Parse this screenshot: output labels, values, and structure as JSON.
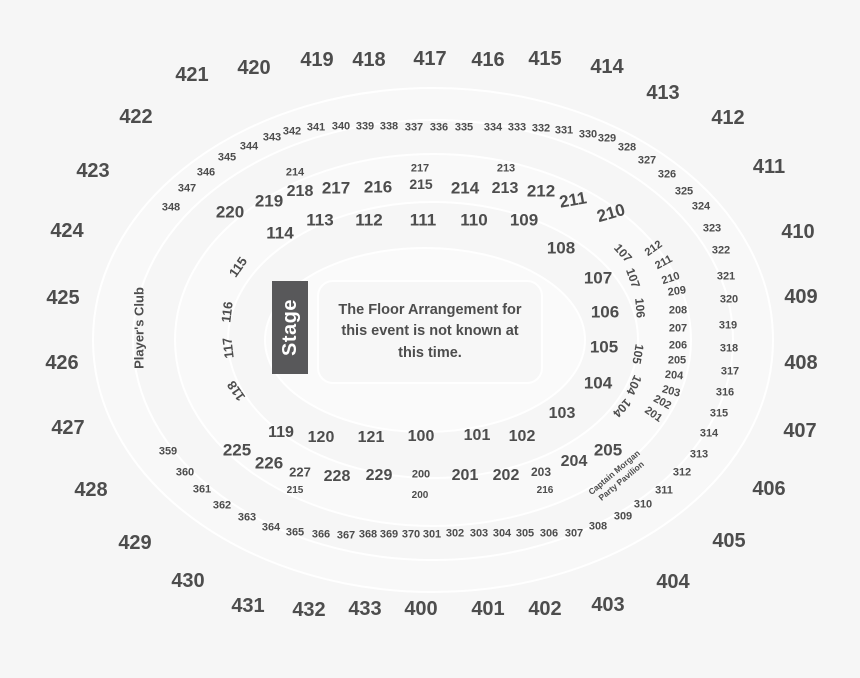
{
  "canvas": {
    "bg": "#f6f6f6",
    "outline": "#ffffff",
    "text_color": "#4d4d4d",
    "ring_fills": [
      "#f8f8f8",
      "#f6f6f6",
      "#f9f9f9",
      "#f6f6f6",
      "#fafafa"
    ]
  },
  "stage": {
    "label": "Stage",
    "bg": "#58585a",
    "text_color": "#ffffff"
  },
  "floor_note": {
    "line1": "The Floor Arrangement for",
    "line2": "this event is not known at",
    "line3": "this time."
  },
  "players_club": {
    "label": "Player's Club"
  },
  "party_pavilion": {
    "line1": "Captain Morgan",
    "line2": "Party Pavilion"
  },
  "labels": [
    {
      "t": "421",
      "x": 192,
      "y": 75,
      "s": 20
    },
    {
      "t": "422",
      "x": 136,
      "y": 117,
      "s": 20
    },
    {
      "t": "423",
      "x": 93,
      "y": 171,
      "s": 20
    },
    {
      "t": "424",
      "x": 67,
      "y": 231,
      "s": 20
    },
    {
      "t": "425",
      "x": 63,
      "y": 298,
      "s": 20
    },
    {
      "t": "426",
      "x": 62,
      "y": 363,
      "s": 20
    },
    {
      "t": "427",
      "x": 68,
      "y": 428,
      "s": 20
    },
    {
      "t": "428",
      "x": 91,
      "y": 490,
      "s": 20
    },
    {
      "t": "429",
      "x": 135,
      "y": 543,
      "s": 20
    },
    {
      "t": "430",
      "x": 188,
      "y": 581,
      "s": 20
    },
    {
      "t": "431",
      "x": 248,
      "y": 606,
      "s": 20
    },
    {
      "t": "432",
      "x": 309,
      "y": 610,
      "s": 20
    },
    {
      "t": "433",
      "x": 365,
      "y": 609,
      "s": 20
    },
    {
      "t": "400",
      "x": 421,
      "y": 609,
      "s": 20
    },
    {
      "t": "401",
      "x": 488,
      "y": 609,
      "s": 20
    },
    {
      "t": "402",
      "x": 545,
      "y": 609,
      "s": 20
    },
    {
      "t": "403",
      "x": 608,
      "y": 605,
      "s": 20
    },
    {
      "t": "404",
      "x": 673,
      "y": 582,
      "s": 20
    },
    {
      "t": "405",
      "x": 729,
      "y": 541,
      "s": 20
    },
    {
      "t": "406",
      "x": 769,
      "y": 489,
      "s": 20
    },
    {
      "t": "407",
      "x": 800,
      "y": 431,
      "s": 20
    },
    {
      "t": "408",
      "x": 801,
      "y": 363,
      "s": 20
    },
    {
      "t": "409",
      "x": 801,
      "y": 297,
      "s": 20
    },
    {
      "t": "410",
      "x": 798,
      "y": 232,
      "s": 20
    },
    {
      "t": "411",
      "x": 769,
      "y": 167,
      "s": 20
    },
    {
      "t": "412",
      "x": 728,
      "y": 118,
      "s": 20
    },
    {
      "t": "413",
      "x": 663,
      "y": 93,
      "s": 20
    },
    {
      "t": "414",
      "x": 607,
      "y": 67,
      "s": 20
    },
    {
      "t": "415",
      "x": 545,
      "y": 59,
      "s": 20
    },
    {
      "t": "416",
      "x": 488,
      "y": 60,
      "s": 20
    },
    {
      "t": "417",
      "x": 430,
      "y": 59,
      "s": 20
    },
    {
      "t": "418",
      "x": 369,
      "y": 60,
      "s": 20
    },
    {
      "t": "419",
      "x": 317,
      "y": 60,
      "s": 20
    },
    {
      "t": "420",
      "x": 254,
      "y": 68,
      "s": 20
    },
    {
      "t": "343",
      "x": 272,
      "y": 138,
      "s": 11
    },
    {
      "t": "342",
      "x": 292,
      "y": 132,
      "s": 11
    },
    {
      "t": "341",
      "x": 316,
      "y": 128,
      "s": 11
    },
    {
      "t": "340",
      "x": 341,
      "y": 127,
      "s": 11
    },
    {
      "t": "339",
      "x": 365,
      "y": 127,
      "s": 11
    },
    {
      "t": "338",
      "x": 389,
      "y": 127,
      "s": 11
    },
    {
      "t": "337",
      "x": 414,
      "y": 128,
      "s": 11
    },
    {
      "t": "336",
      "x": 439,
      "y": 128,
      "s": 11
    },
    {
      "t": "335",
      "x": 464,
      "y": 128,
      "s": 11
    },
    {
      "t": "334",
      "x": 493,
      "y": 128,
      "s": 11
    },
    {
      "t": "333",
      "x": 517,
      "y": 128,
      "s": 11
    },
    {
      "t": "332",
      "x": 541,
      "y": 129,
      "s": 11
    },
    {
      "t": "331",
      "x": 564,
      "y": 131,
      "s": 11
    },
    {
      "t": "330",
      "x": 588,
      "y": 135,
      "s": 11
    },
    {
      "t": "329",
      "x": 607,
      "y": 139,
      "s": 11
    },
    {
      "t": "328",
      "x": 627,
      "y": 148,
      "s": 11
    },
    {
      "t": "327",
      "x": 647,
      "y": 161,
      "s": 11
    },
    {
      "t": "326",
      "x": 667,
      "y": 175,
      "s": 11
    },
    {
      "t": "325",
      "x": 684,
      "y": 192,
      "s": 11
    },
    {
      "t": "324",
      "x": 701,
      "y": 207,
      "s": 11
    },
    {
      "t": "323",
      "x": 712,
      "y": 229,
      "s": 11
    },
    {
      "t": "322",
      "x": 721,
      "y": 251,
      "s": 11
    },
    {
      "t": "321",
      "x": 726,
      "y": 277,
      "s": 11
    },
    {
      "t": "320",
      "x": 729,
      "y": 300,
      "s": 11
    },
    {
      "t": "319",
      "x": 728,
      "y": 326,
      "s": 11
    },
    {
      "t": "318",
      "x": 729,
      "y": 349,
      "s": 11
    },
    {
      "t": "317",
      "x": 730,
      "y": 372,
      "s": 11
    },
    {
      "t": "316",
      "x": 725,
      "y": 393,
      "s": 11
    },
    {
      "t": "315",
      "x": 719,
      "y": 414,
      "s": 11
    },
    {
      "t": "314",
      "x": 709,
      "y": 434,
      "s": 11
    },
    {
      "t": "313",
      "x": 699,
      "y": 455,
      "s": 11
    },
    {
      "t": "312",
      "x": 682,
      "y": 473,
      "s": 11
    },
    {
      "t": "311",
      "x": 664,
      "y": 491,
      "s": 11
    },
    {
      "t": "310",
      "x": 643,
      "y": 505,
      "s": 11
    },
    {
      "t": "309",
      "x": 623,
      "y": 517,
      "s": 11
    },
    {
      "t": "308",
      "x": 598,
      "y": 527,
      "s": 11
    },
    {
      "t": "307",
      "x": 574,
      "y": 534,
      "s": 11
    },
    {
      "t": "306",
      "x": 549,
      "y": 534,
      "s": 11
    },
    {
      "t": "305",
      "x": 525,
      "y": 534,
      "s": 11
    },
    {
      "t": "304",
      "x": 502,
      "y": 534,
      "s": 11
    },
    {
      "t": "303",
      "x": 479,
      "y": 534,
      "s": 11
    },
    {
      "t": "302",
      "x": 455,
      "y": 534,
      "s": 11
    },
    {
      "t": "301",
      "x": 432,
      "y": 535,
      "s": 11
    },
    {
      "t": "370",
      "x": 411,
      "y": 535,
      "s": 11
    },
    {
      "t": "369",
      "x": 389,
      "y": 535,
      "s": 11
    },
    {
      "t": "368",
      "x": 368,
      "y": 535,
      "s": 11
    },
    {
      "t": "367",
      "x": 346,
      "y": 536,
      "s": 11
    },
    {
      "t": "366",
      "x": 321,
      "y": 535,
      "s": 11
    },
    {
      "t": "365",
      "x": 295,
      "y": 533,
      "s": 11
    },
    {
      "t": "364",
      "x": 271,
      "y": 528,
      "s": 11
    },
    {
      "t": "363",
      "x": 247,
      "y": 518,
      "s": 11
    },
    {
      "t": "362",
      "x": 222,
      "y": 506,
      "s": 11
    },
    {
      "t": "361",
      "x": 202,
      "y": 490,
      "s": 11
    },
    {
      "t": "360",
      "x": 185,
      "y": 473,
      "s": 11
    },
    {
      "t": "359",
      "x": 168,
      "y": 452,
      "s": 11
    },
    {
      "t": "344",
      "x": 249,
      "y": 147,
      "s": 11
    },
    {
      "t": "345",
      "x": 227,
      "y": 158,
      "s": 11
    },
    {
      "t": "346",
      "x": 206,
      "y": 173,
      "s": 11
    },
    {
      "t": "347",
      "x": 187,
      "y": 189,
      "s": 11
    },
    {
      "t": "348",
      "x": 171,
      "y": 208,
      "s": 11
    },
    {
      "t": "220",
      "x": 230,
      "y": 212,
      "s": 17
    },
    {
      "t": "219",
      "x": 269,
      "y": 201,
      "s": 17
    },
    {
      "t": "218",
      "x": 300,
      "y": 192,
      "s": 16
    },
    {
      "t": "217",
      "x": 336,
      "y": 188,
      "s": 17
    },
    {
      "t": "216",
      "x": 378,
      "y": 187,
      "s": 17
    },
    {
      "t": "215",
      "x": 421,
      "y": 184,
      "s": 14
    },
    {
      "t": "214",
      "x": 465,
      "y": 188,
      "s": 17
    },
    {
      "t": "213",
      "x": 505,
      "y": 189,
      "s": 16
    },
    {
      "t": "212",
      "x": 541,
      "y": 191,
      "s": 17
    },
    {
      "t": "211",
      "x": 573,
      "y": 200,
      "s": 17,
      "r": -10
    },
    {
      "t": "210",
      "x": 611,
      "y": 213,
      "s": 17,
      "r": -16
    },
    {
      "t": "214",
      "x": 295,
      "y": 173,
      "s": 11
    },
    {
      "t": "217",
      "x": 420,
      "y": 169,
      "s": 11
    },
    {
      "t": "213",
      "x": 506,
      "y": 169,
      "s": 11
    },
    {
      "t": "114",
      "x": 280,
      "y": 233,
      "s": 17
    },
    {
      "t": "113",
      "x": 320,
      "y": 220,
      "s": 17
    },
    {
      "t": "112",
      "x": 369,
      "y": 220,
      "s": 17
    },
    {
      "t": "111",
      "x": 423,
      "y": 220,
      "s": 17
    },
    {
      "t": "110",
      "x": 474,
      "y": 220,
      "s": 17
    },
    {
      "t": "109",
      "x": 524,
      "y": 220,
      "s": 17
    },
    {
      "t": "108",
      "x": 561,
      "y": 248,
      "s": 17
    },
    {
      "t": "107",
      "x": 598,
      "y": 278,
      "s": 17
    },
    {
      "t": "106",
      "x": 605,
      "y": 312,
      "s": 17
    },
    {
      "t": "105",
      "x": 604,
      "y": 347,
      "s": 17
    },
    {
      "t": "104",
      "x": 598,
      "y": 383,
      "s": 17
    },
    {
      "t": "103",
      "x": 562,
      "y": 414,
      "s": 16
    },
    {
      "t": "119",
      "x": 281,
      "y": 433,
      "s": 16
    },
    {
      "t": "120",
      "x": 321,
      "y": 438,
      "s": 16
    },
    {
      "t": "121",
      "x": 371,
      "y": 438,
      "s": 16
    },
    {
      "t": "100",
      "x": 421,
      "y": 437,
      "s": 16
    },
    {
      "t": "101",
      "x": 477,
      "y": 436,
      "s": 16
    },
    {
      "t": "102",
      "x": 522,
      "y": 437,
      "s": 16
    },
    {
      "t": "115",
      "x": 238,
      "y": 267,
      "s": 13,
      "r": -55
    },
    {
      "t": "116",
      "x": 227,
      "y": 312,
      "s": 13,
      "r": -83
    },
    {
      "t": "117",
      "x": 228,
      "y": 348,
      "s": 13,
      "r": -97
    },
    {
      "t": "118",
      "x": 236,
      "y": 391,
      "s": 13,
      "r": -125
    },
    {
      "t": "107",
      "x": 623,
      "y": 253,
      "s": 12,
      "r": 48
    },
    {
      "t": "107",
      "x": 633,
      "y": 278,
      "s": 12,
      "r": 70
    },
    {
      "t": "106",
      "x": 640,
      "y": 308,
      "s": 12,
      "r": 85
    },
    {
      "t": "105",
      "x": 638,
      "y": 354,
      "s": 12,
      "r": 100
    },
    {
      "t": "104",
      "x": 634,
      "y": 385,
      "s": 12,
      "r": 115
    },
    {
      "t": "104",
      "x": 622,
      "y": 408,
      "s": 12,
      "r": 132
    },
    {
      "t": "212",
      "x": 654,
      "y": 249,
      "s": 11,
      "r": -35
    },
    {
      "t": "211",
      "x": 664,
      "y": 263,
      "s": 11,
      "r": -28
    },
    {
      "t": "210",
      "x": 671,
      "y": 279,
      "s": 11,
      "r": -18
    },
    {
      "t": "209",
      "x": 677,
      "y": 292,
      "s": 11,
      "r": -8
    },
    {
      "t": "208",
      "x": 678,
      "y": 311,
      "s": 11
    },
    {
      "t": "207",
      "x": 678,
      "y": 329,
      "s": 11
    },
    {
      "t": "206",
      "x": 678,
      "y": 346,
      "s": 11
    },
    {
      "t": "205",
      "x": 677,
      "y": 361,
      "s": 11
    },
    {
      "t": "204",
      "x": 674,
      "y": 376,
      "s": 11,
      "r": 5
    },
    {
      "t": "203",
      "x": 671,
      "y": 392,
      "s": 11,
      "r": 15
    },
    {
      "t": "202",
      "x": 662,
      "y": 403,
      "s": 11,
      "r": 28
    },
    {
      "t": "201",
      "x": 653,
      "y": 415,
      "s": 11,
      "r": 35
    },
    {
      "t": "225",
      "x": 237,
      "y": 450,
      "s": 17
    },
    {
      "t": "226",
      "x": 269,
      "y": 463,
      "s": 17
    },
    {
      "t": "227",
      "x": 300,
      "y": 472,
      "s": 13
    },
    {
      "t": "228",
      "x": 337,
      "y": 477,
      "s": 16
    },
    {
      "t": "229",
      "x": 379,
      "y": 476,
      "s": 16
    },
    {
      "t": "200",
      "x": 421,
      "y": 475,
      "s": 11
    },
    {
      "t": "201",
      "x": 465,
      "y": 476,
      "s": 16
    },
    {
      "t": "202",
      "x": 506,
      "y": 476,
      "s": 16
    },
    {
      "t": "203",
      "x": 541,
      "y": 472,
      "s": 12
    },
    {
      "t": "204",
      "x": 574,
      "y": 462,
      "s": 16
    },
    {
      "t": "205",
      "x": 608,
      "y": 450,
      "s": 17
    },
    {
      "t": "215",
      "x": 295,
      "y": 491,
      "s": 10
    },
    {
      "t": "200",
      "x": 420,
      "y": 496,
      "s": 10
    },
    {
      "t": "216",
      "x": 545,
      "y": 491,
      "s": 10
    }
  ]
}
